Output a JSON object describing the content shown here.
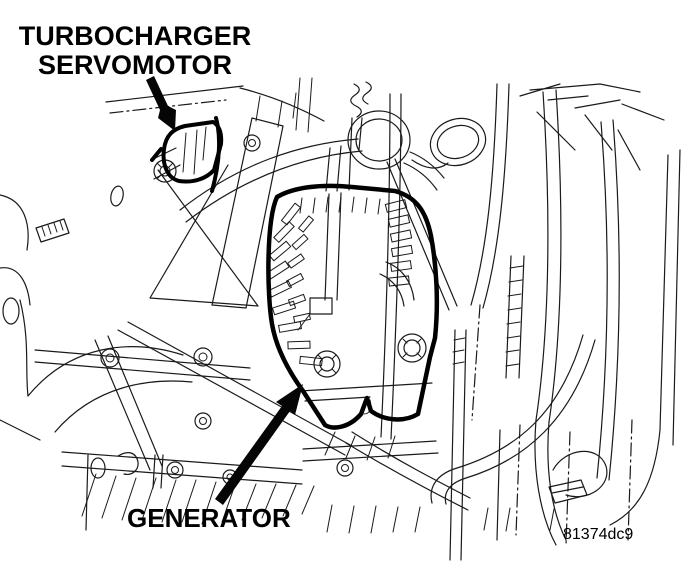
{
  "diagram": {
    "callouts": {
      "turbocharger_servomotor": {
        "line1": "TURBOCHARGER",
        "line2": "SERVOMOTOR"
      },
      "generator": {
        "label": "GENERATOR"
      }
    },
    "figure_code": "81374dc9",
    "colors": {
      "background": "#ffffff",
      "line": "#1a1a1a",
      "highlight_outline": "#000000",
      "text": "#000000"
    }
  }
}
